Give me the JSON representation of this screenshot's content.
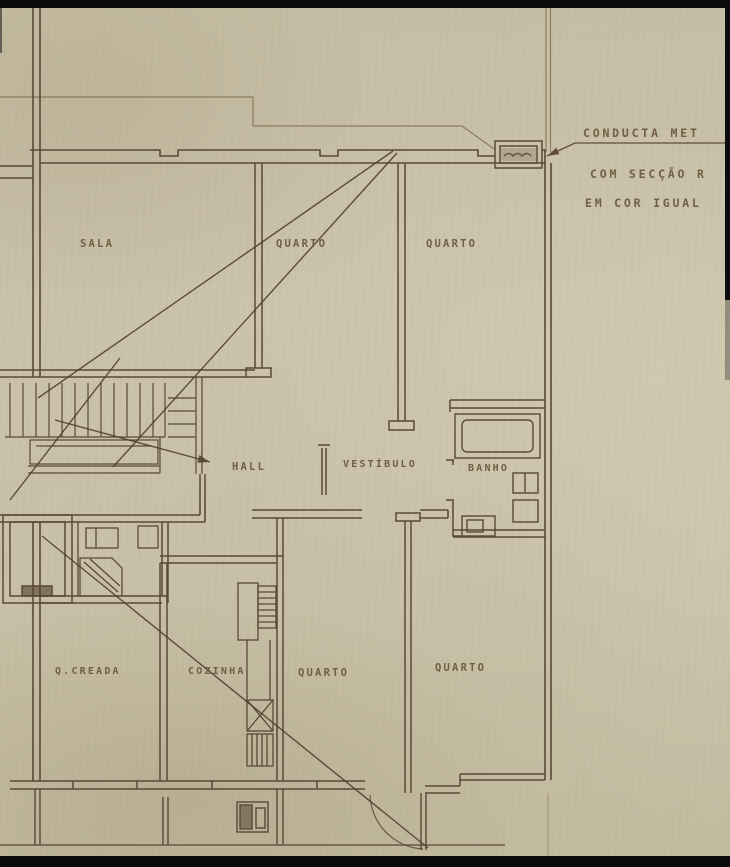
{
  "sheet": {
    "description": "Hand-drawn apartment floor plan on aged paper (scan crop)",
    "colors": {
      "paper": "#c8c0a6",
      "ink": "#5a4837",
      "ink_faint": "#8a7a62",
      "border_black": "#0b0b0b"
    },
    "rooms": {
      "sala": "SALA",
      "quarto_top_middle": "QUARTO",
      "quarto_top_right": "QUARTO",
      "hall": "HALL",
      "vestibulo": "VESTÍBULO",
      "banho": "BANHO",
      "quarto_creada": "Q.CREADA",
      "cozinha": "COZINHA",
      "quarto_bottom_middle": "QUARTO",
      "quarto_bottom_right": "QUARTO"
    },
    "annotation": {
      "line1": "CONDUCTA MET",
      "line2": "COM SECÇÃO R",
      "line3": "EM COR IGUAL"
    }
  }
}
